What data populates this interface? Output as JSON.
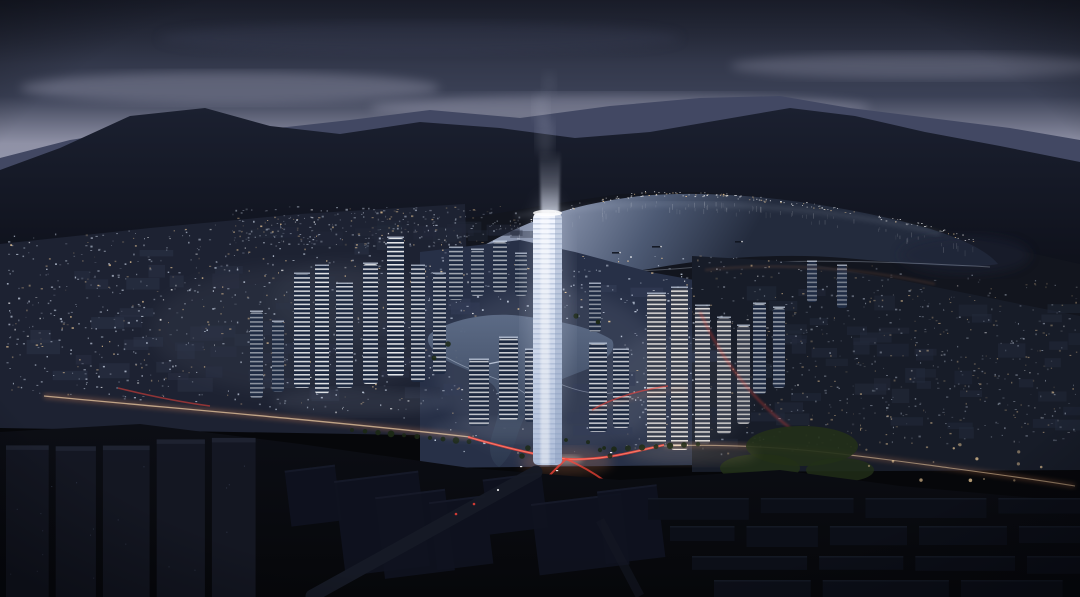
{
  "scene": {
    "type": "architectural-night-rendering",
    "description": "Dusk aerial rendering of a lakeside masterplan city: a glowing white landmark tower with a vertical light beam at the center, illuminated high-rise clusters and dense mid-rise blocks, an inner lake with a river channel, a wide bay reflecting the sky beneath dark mountain ridges, a road interchange with red traffic light trails, and unlit dark building blocks in the foreground.",
    "elements": [
      "sky",
      "clouds",
      "far-mountain-ridge",
      "near-mountain-ridge",
      "distant-shore-hills",
      "bay-water",
      "shoreline-lights",
      "boats",
      "city-blocks-west",
      "city-blocks-east",
      "tower-cluster-west",
      "tower-cluster-east",
      "inner-lake",
      "footbridge",
      "waterfront-promenade",
      "landmark-tower",
      "light-beam",
      "lit-roads",
      "road-interchange",
      "traffic-light-trails",
      "trees",
      "parks",
      "dark-foreground-blocks"
    ]
  },
  "palette": {
    "sky_top": "#232736",
    "sky_mid": "#3b4156",
    "sky_cloud": "#8f91a6",
    "sky_horizon": "#9397ab",
    "mountain_far": "#424863",
    "mountain_near_top": "#1b2030",
    "mountain_near_bottom": "#0a0c14",
    "far_shore": "#12151e",
    "bay_bright": "#8893ac",
    "bay_mid": "#4d5a74",
    "bay_dark": "#232b3d",
    "lake_bright": "#5e6d88",
    "lake_dark": "#2c384e",
    "city_base_left": "#1d2232",
    "city_base_center": "#273047",
    "city_base_right": "#171c28",
    "light_cool": "#cfd9ea",
    "light_warm": "#ffd9a2",
    "light_white": "#ffffff",
    "tower_light": "#f2f6ff",
    "tower_shade": "#aebdd8",
    "beam_white": "#e8eeff",
    "road_glow": "#ff9a62",
    "road_core": "#ffddb0",
    "trail_red": "#ff4438",
    "trail_core": "#ff8a78",
    "tree_green": "#1c2916",
    "park_green": "#223018",
    "fg_top": "#0c0e15",
    "fg_bottom": "#06070a"
  }
}
